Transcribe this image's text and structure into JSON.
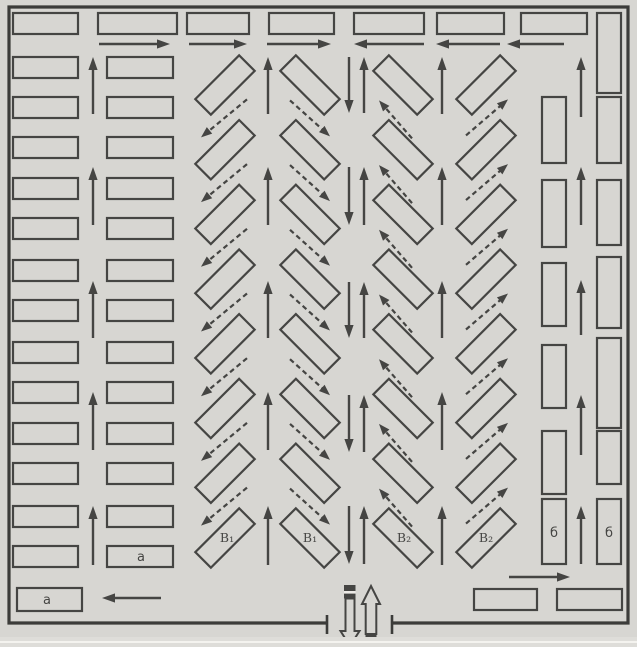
{
  "diagram": {
    "colors": {
      "background": "#d7d6d2",
      "line": "#454543",
      "border": "#3c3c3a",
      "gate_band": "#eceae6",
      "scan_strip": "#deddd9",
      "scan_line": "#f4f3ef"
    },
    "labels": {
      "left_row_stall": "а",
      "left_corner_stall": "а",
      "diag_col1_stall": "В₁",
      "diag_col2_stall": "В₁",
      "diag_col3_stall": "В₂",
      "diag_col4_stall": "В₂",
      "right_inner_stall": "б",
      "right_outer_stall": "б"
    }
  }
}
